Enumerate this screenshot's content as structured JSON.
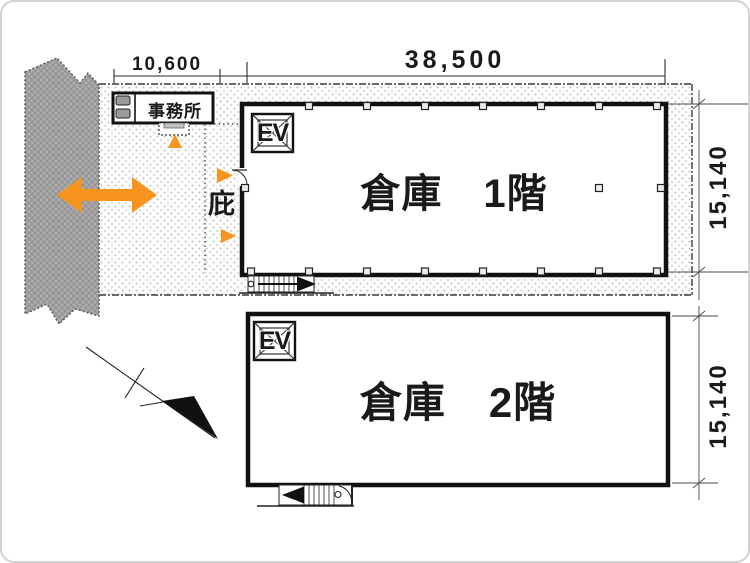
{
  "plan": {
    "title": "倉庫平面図",
    "dimensions": {
      "office_width": "10,600",
      "warehouse_width": "38,500",
      "floor1_depth": "15,140",
      "floor2_depth": "15,140"
    },
    "labels": {
      "office": "事務所",
      "canopy": "庇",
      "floor1": "倉庫　1階",
      "floor2": "倉庫　2階",
      "elevator1": "EV",
      "elevator2": "EV"
    },
    "icons": {
      "road": "road-hatch-strip",
      "north_arrow": "north-arrow",
      "access_arrow": "double-headed-orange-arrow",
      "entrance_arrows": "orange-entrance-triangles",
      "stairs": "stair-symbols"
    },
    "colors": {
      "accent_orange": "#F7941E",
      "road_gray": "#ABABAB",
      "line_black": "#1a1a1a",
      "stipple_dot": "#b3b3b3"
    }
  }
}
